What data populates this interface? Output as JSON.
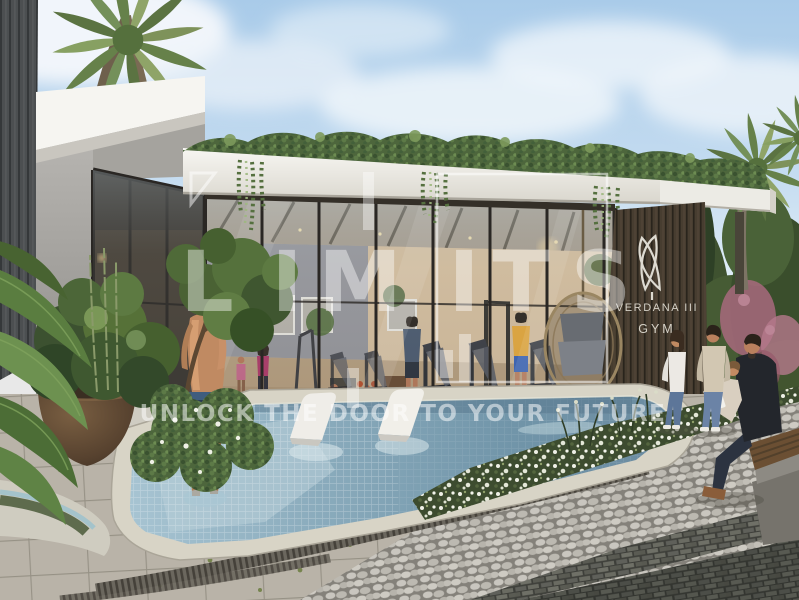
{
  "meta": {
    "description": "Architectural rendering of the Verdana III gym pavilion: glass facade with treadmills inside, rooftop hedge with hanging vines, outdoor pool with two white in-water loungers, a man standing in the pool, cobblestone walkway with a couple walking and a father reading to a child on a wooden bench, palm trees and bougainvillea."
  },
  "watermark": {
    "brand": "LIMITS",
    "letters": [
      "L",
      "I",
      "M",
      "I",
      "T",
      "S"
    ],
    "tagline": "UNLOCK THE DOOR TO YOUR FUTURE",
    "color": "#ffffff"
  },
  "sign": {
    "name_line": "VERDANA III",
    "type_line": "GYM",
    "logo": "leaf-logo"
  },
  "palette": {
    "sky_top": "#aecde9",
    "sky_bottom": "#dcebf6",
    "roof_white": "#f5f4f0",
    "glass_interior_warm": "#cdb596",
    "wood_slats": "#55493c",
    "pool_shallow": "#a7c4d2",
    "pool_deep": "#6b8ba0",
    "deck_tile": "#c1bcb0",
    "cobblestone": "#b2afa8",
    "dark_brick": "#53544d",
    "foliage": "#4d663c",
    "bougainvillea": "#a86a7e",
    "flower_white": "#eff0e6",
    "shirt_yellow": "#e6a93c",
    "top_magenta": "#b03a6a"
  }
}
